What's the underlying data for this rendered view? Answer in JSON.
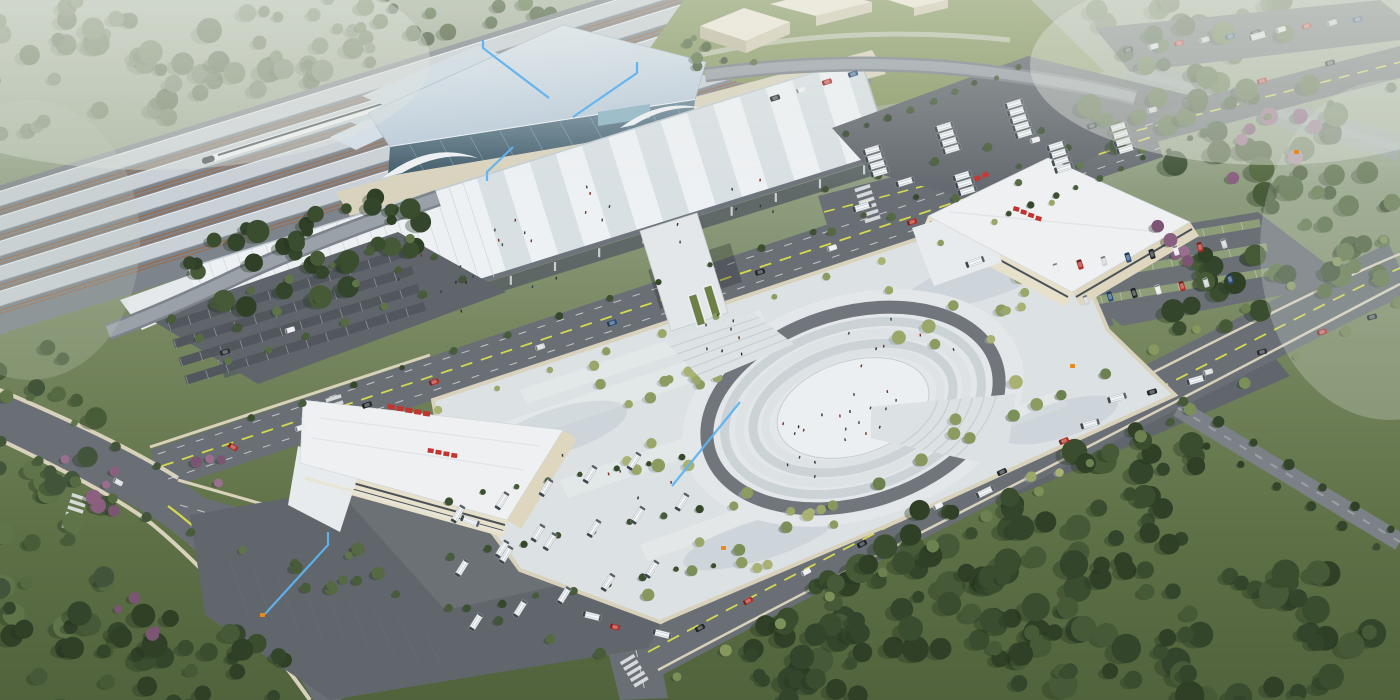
{
  "meta": {
    "domain": "Natural-Image",
    "subject": "Aerial architectural rendering of a high-speed railway station transit hub",
    "view": "oblique bird's-eye view, scene rotated diagonally",
    "lighting": "overcast daylight with atmospheric haze at top corners"
  },
  "colors": {
    "haze_top": "#a9b4a2",
    "land": "#5d6f45",
    "forest_dark": "#33432a",
    "forest_mid": "#495c39",
    "lawn": "#8a9a66",
    "asphalt": "#696f75",
    "asphalt_dark": "#60666c",
    "lane_yellow": "#d5d94e",
    "sidewalk": "#d8d1bb",
    "plaza": "#dce1e3",
    "plaza_shade": "#c6cfd5",
    "station_roof": "#c9d7e4",
    "glass": "#4d6b7b",
    "canopy_white": "#eef1f3",
    "canopy_stripe": "#d9e0e4",
    "fascia": "#6d747b",
    "oval_ring": "#70767c",
    "oval_inner": "#eceff1",
    "terminal_roof": "#eef0f2",
    "terminal_wall": "#e7e0cb",
    "window_band": "#4a5258",
    "sign_red": "#c23430",
    "bus_body": "#f4f6f7",
    "train_white": "#f3f5f7",
    "track_brown": "#9c6a46",
    "platform": "#c9d0d6",
    "annotation_blue": "#5fb3f0",
    "marker_orange": "#e78a1d"
  },
  "scene": {
    "railway": {
      "label": "railway corridor with parallel platform canopies",
      "platform_canopy_count": 5,
      "train_label": "white high-speed train"
    },
    "station": {
      "label": "main station hall",
      "features": [
        "long-span pale blue roof",
        "diagonal-mullion glass curtain wall",
        "wing-shaped white entrance canopies"
      ]
    },
    "concourse_canopy": {
      "label": "striped elevated concourse canopy with colonnade"
    },
    "footbridge": {
      "label": "pedestrian bridge with twin escalators descending to plaza"
    },
    "plaza": {
      "label": "station forecourt plaza",
      "amphitheater": "elliptical sunken plaza with concentric steps and dark ring path",
      "tree_grid": true
    },
    "terminals": [
      {
        "label": "bus terminal building west",
        "signage": "red characters (illegible at this scale)"
      },
      {
        "label": "bus terminal building east",
        "signage": "red characters (illegible at this scale)"
      }
    ],
    "parking": {
      "west_car_lot": "mostly empty stalls with tree rows",
      "east_car_lot": "occupied stalls with grass pavers",
      "north_bus_depot": "clusters of white buses",
      "south_bus_lot": "angled rows of white buses with hedges"
    },
    "roads": {
      "markings": [
        "yellow center lines",
        "white lane dashes",
        "zebra crossings"
      ]
    },
    "landscape": {
      "forest": "dense tree masses on all corners",
      "accents": "pink and purple blossom trees"
    },
    "annotations": {
      "leader_line_count": 5,
      "marker_count": 4
    }
  }
}
